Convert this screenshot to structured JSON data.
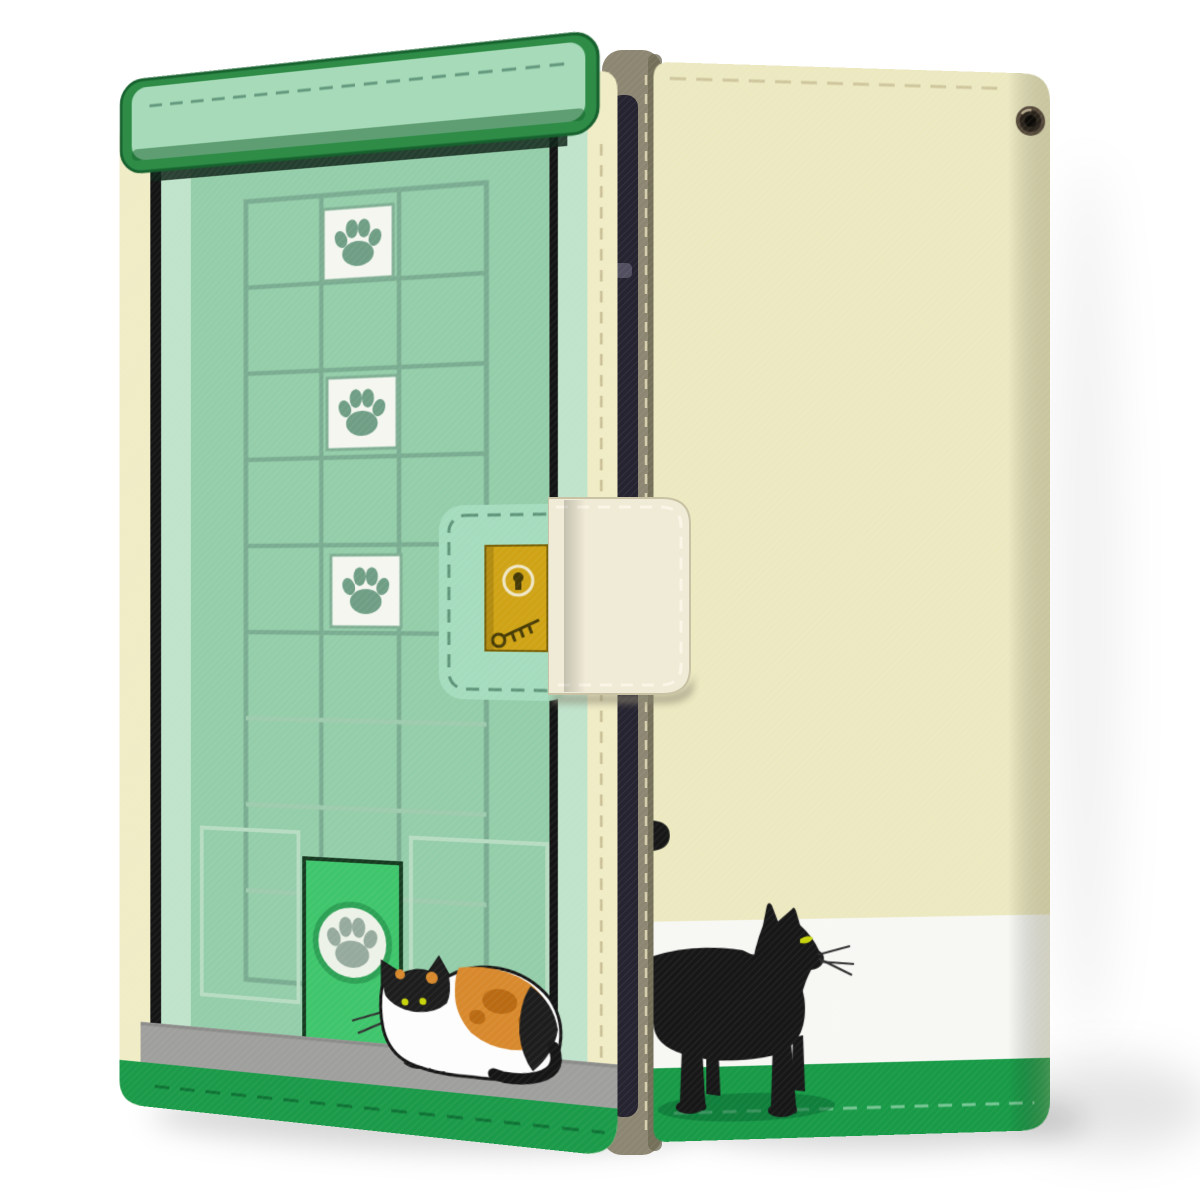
{
  "product": {
    "type": "product-photo",
    "subject": "wallet flip phone case shown front and back",
    "theme": "cat door design with paw-print windows, calico cat on front, black cat on back",
    "visible_text": "",
    "front_cover_parts": [
      "green-door-lintel-bar",
      "door-grid-panel",
      "paw-print-windows",
      "lock-plaque",
      "gold-lock-plate",
      "pet-door",
      "calico-cat-illustration",
      "gray-step-ledge",
      "green-bottom-band",
      "cream-edge-strips"
    ],
    "back_cover_parts": [
      "cream-leather-body",
      "strap-eyelet",
      "top-stitching",
      "black-cat-illustration",
      "white-band",
      "green-bottom-band"
    ],
    "hardware_parts": [
      "magnetic-clasp-strap",
      "spine",
      "phone-edge-visible-in-gap"
    ],
    "paw_square_count": 3,
    "icons": [
      "paw-icon",
      "keyhole-icon",
      "key-doodle-icon",
      "eyelet-grommet"
    ]
  },
  "colors": {
    "bg": "#ffffff",
    "mintFace": "#94cda9",
    "mintBar": "#a6dab8",
    "mintPlaque": "#a5dcbe",
    "barGreen": "#2e8c47",
    "barGreenDark": "#17612e",
    "sageGrid": "#7aac91",
    "sageGridLight": "#9ecbad",
    "panelLight": "#b7dcc2",
    "pawSquareWhite": "#f4f6ef",
    "pawSquareBorder": "#7fae93",
    "pawGreen": "#6f9e85",
    "jambLight": "#bfe3cb",
    "creamEdge": "#f0ecc5",
    "stitchTan": "#c9bf96",
    "blackLine": "#141414",
    "petDoorGreen": "#3fc56c",
    "petDoorBorder": "#153a20",
    "petDoorRing": "#2da155",
    "petDoorCircle": "#edf2e8",
    "pawGray": "#96aa9d",
    "plaqueDash": "#5f9379",
    "gold": "#cfa315",
    "goldDark": "#7a6208",
    "goldDetail": "#453a06",
    "ledgeGray": "#9f9f9d",
    "ledgeGrayDark": "#8b8b89",
    "bandGreen": "#1b9a49",
    "bandStitchDark": "#0e7134",
    "oliveSpine": "#8c8672",
    "oliveDark": "#6e6853",
    "spineStitch": "#ded5b2",
    "phoneDark": "#262430",
    "phoneHighlight": "#5a5868",
    "strapCream": "#f0ebd7",
    "strapStitch": "#faf5e6",
    "strapEdge": "#c9c2a4",
    "creamBody": "#ece9c1",
    "creamBodyDark": "#d8d5ae",
    "whiteBand": "#f7f8f4",
    "bandGreenRight": "#189a47",
    "bandStitchLight": "#8fd2a8",
    "eyeletDark": "#2a241c",
    "eyeletMid": "#55493a",
    "eyeletHole": "#0d0b08",
    "catBlack": "#171717",
    "catShadowGreen": "#0a6a32",
    "eyeYellow": "#c8d40a",
    "whisker": "#2f2f2f",
    "calicoWhite": "#fdfdfd",
    "calicoOutline": "#151515",
    "calicoOrange": "#d8892d",
    "calicoOrangeDark": "#b96a12",
    "calicoBlack": "#1d1d1d",
    "shadowSoft": "rgba(0,0,0,0.16)",
    "shadowSoft2": "rgba(0,0,0,0.10)",
    "shadowFaint": "rgba(0,0,0,0.05)"
  }
}
